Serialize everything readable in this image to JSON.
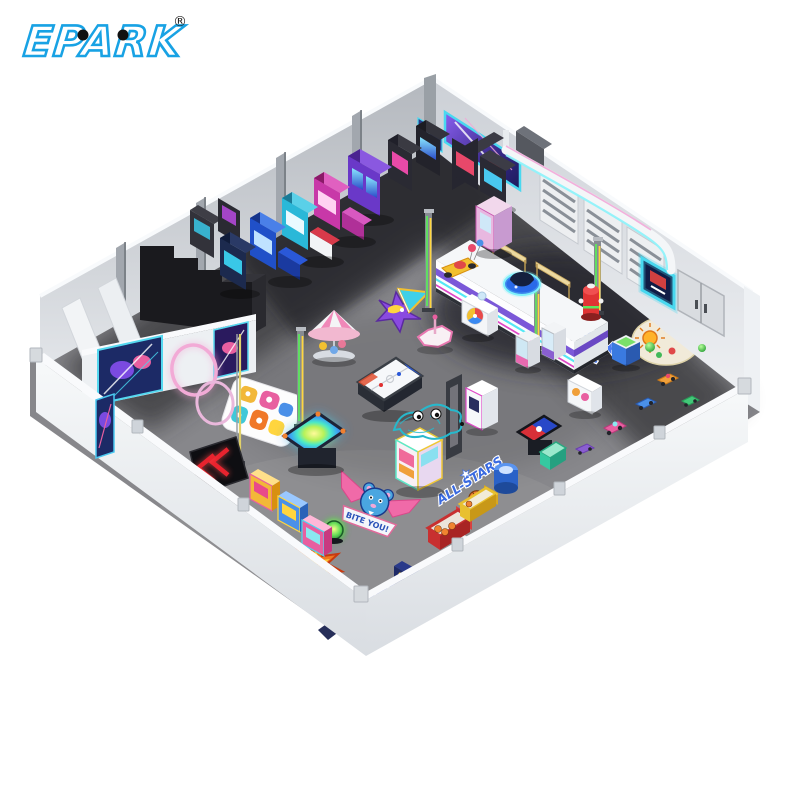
{
  "logo": {
    "text": "EPARK",
    "registered_mark": "®",
    "brand_color": "#18a2e4"
  },
  "decals": {
    "pow": "POW!!",
    "bite_you": "BITE YOU!",
    "stay": "STAY",
    "cool": "COOL",
    "all_stars": "ALL-STARS"
  },
  "counter": {
    "label": "HAPPY"
  },
  "palette": {
    "floor": "#87878b",
    "floor_dark": "#35353b",
    "wall_light": "#e8ebee",
    "neon_cyan": "#55e8f5",
    "neon_magenta": "#e048c8",
    "neon_purple": "#7b58d8",
    "neon_yellow": "#ffd53e",
    "neon_green": "#5ce85c",
    "neon_pink": "#f2a8d8",
    "accent_blue": "#3a6ae0"
  }
}
